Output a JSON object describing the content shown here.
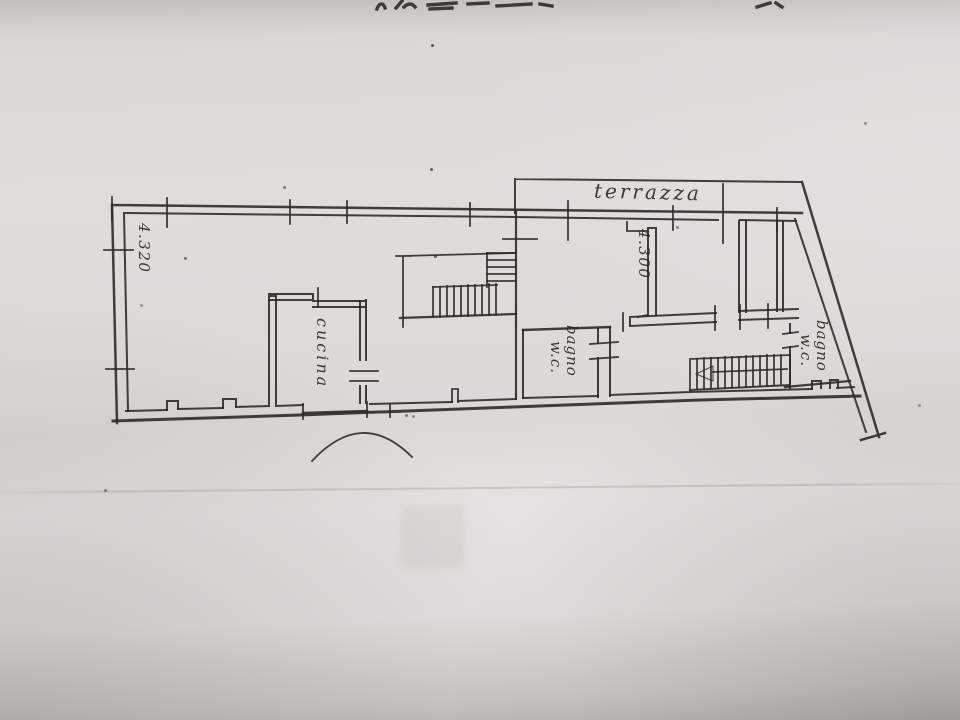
{
  "floor_plan": {
    "room_labels": {
      "terrace": "terrazza",
      "kitchen": "cucina",
      "bathroom_center": {
        "line1": "bagno",
        "line2": "w.c."
      },
      "bathroom_right": {
        "line1": "bagno",
        "line2": "w.c."
      }
    },
    "dimension_labels": {
      "left_room_height": "4.320",
      "right_room_height": "4.300"
    }
  }
}
